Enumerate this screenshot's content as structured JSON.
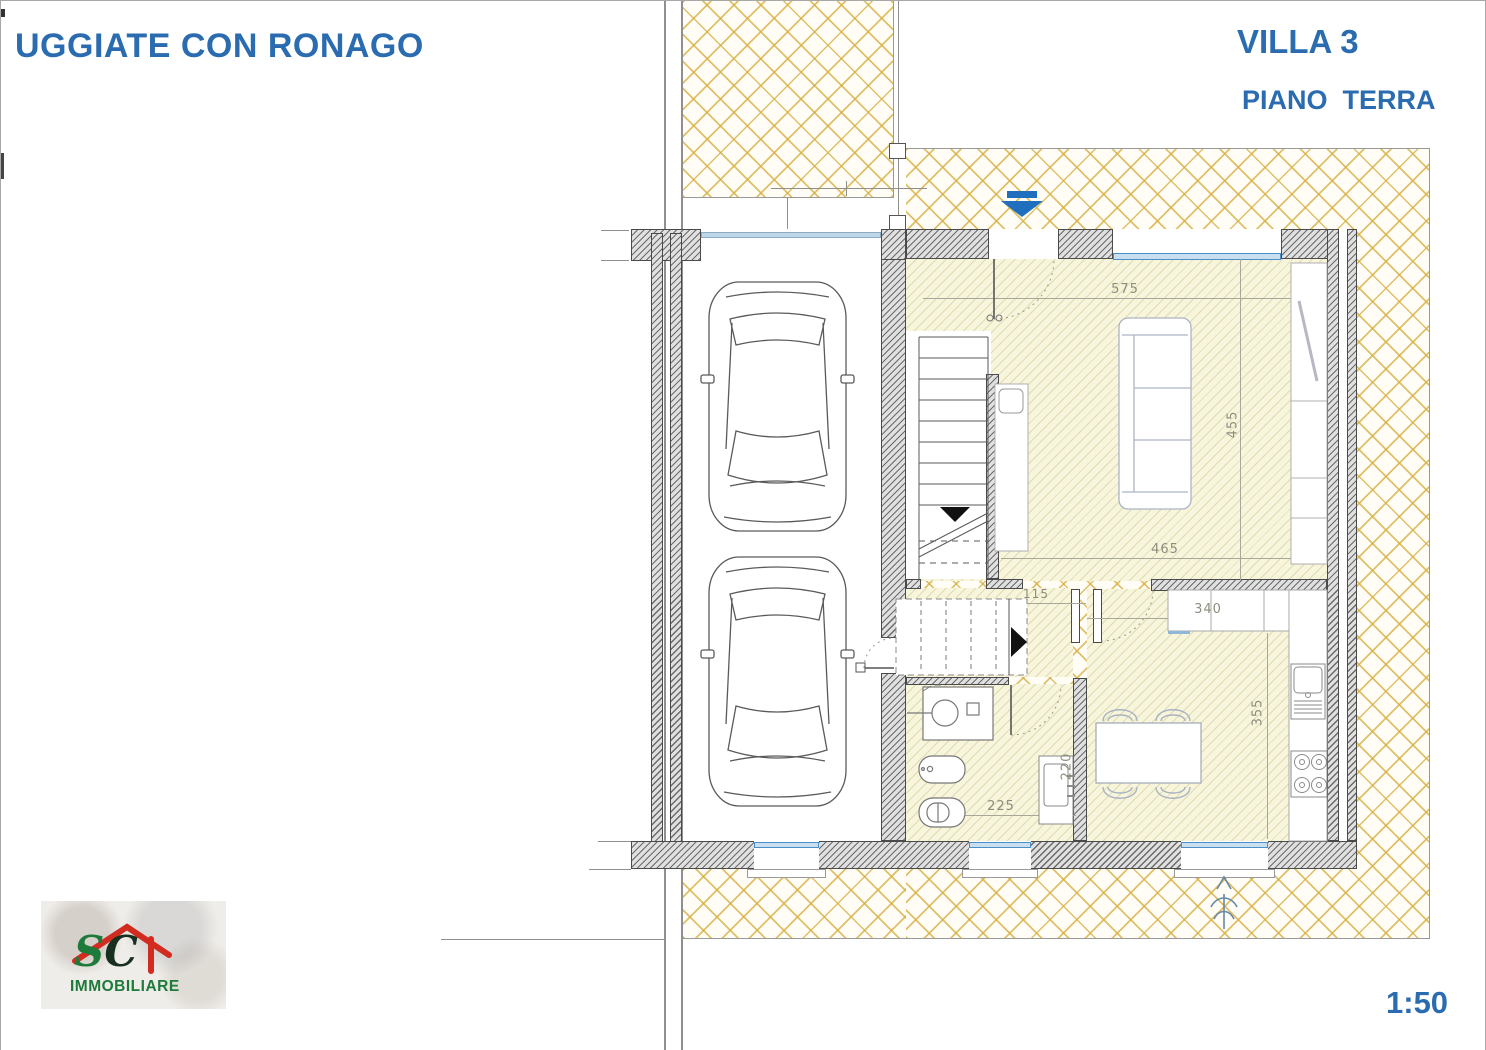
{
  "header": {
    "location_title": "UGGIATE CON RONAGO",
    "villa_label": "VILLA 3",
    "floor_label": "PIANO  TERRA"
  },
  "scale": {
    "label": "1:50"
  },
  "logo": {
    "initial_1": "S",
    "initial_2": "C",
    "company": "IMMOBILIARE"
  },
  "plan": {
    "dimensions": [
      {
        "id": "living-width-top",
        "value": "575"
      },
      {
        "id": "living-height",
        "value": "455"
      },
      {
        "id": "living-width-bottom",
        "value": "465"
      },
      {
        "id": "hall-width",
        "value": "115"
      },
      {
        "id": "kitchen-width",
        "value": "340"
      },
      {
        "id": "kitchen-height",
        "value": "355"
      },
      {
        "id": "corridor-depth",
        "value": "220"
      },
      {
        "id": "bathroom-width",
        "value": "225"
      }
    ],
    "colors": {
      "title_blue": "#2b6cb0",
      "window_blue": "#4a8fc7",
      "entrance_arrow_blue": "#1f6fbe",
      "hatch_gold": "#d6af40",
      "floor_tint": "#f7f5dc",
      "logo_green": "#1e7a3a",
      "logo_red": "#d22b1f"
    }
  }
}
